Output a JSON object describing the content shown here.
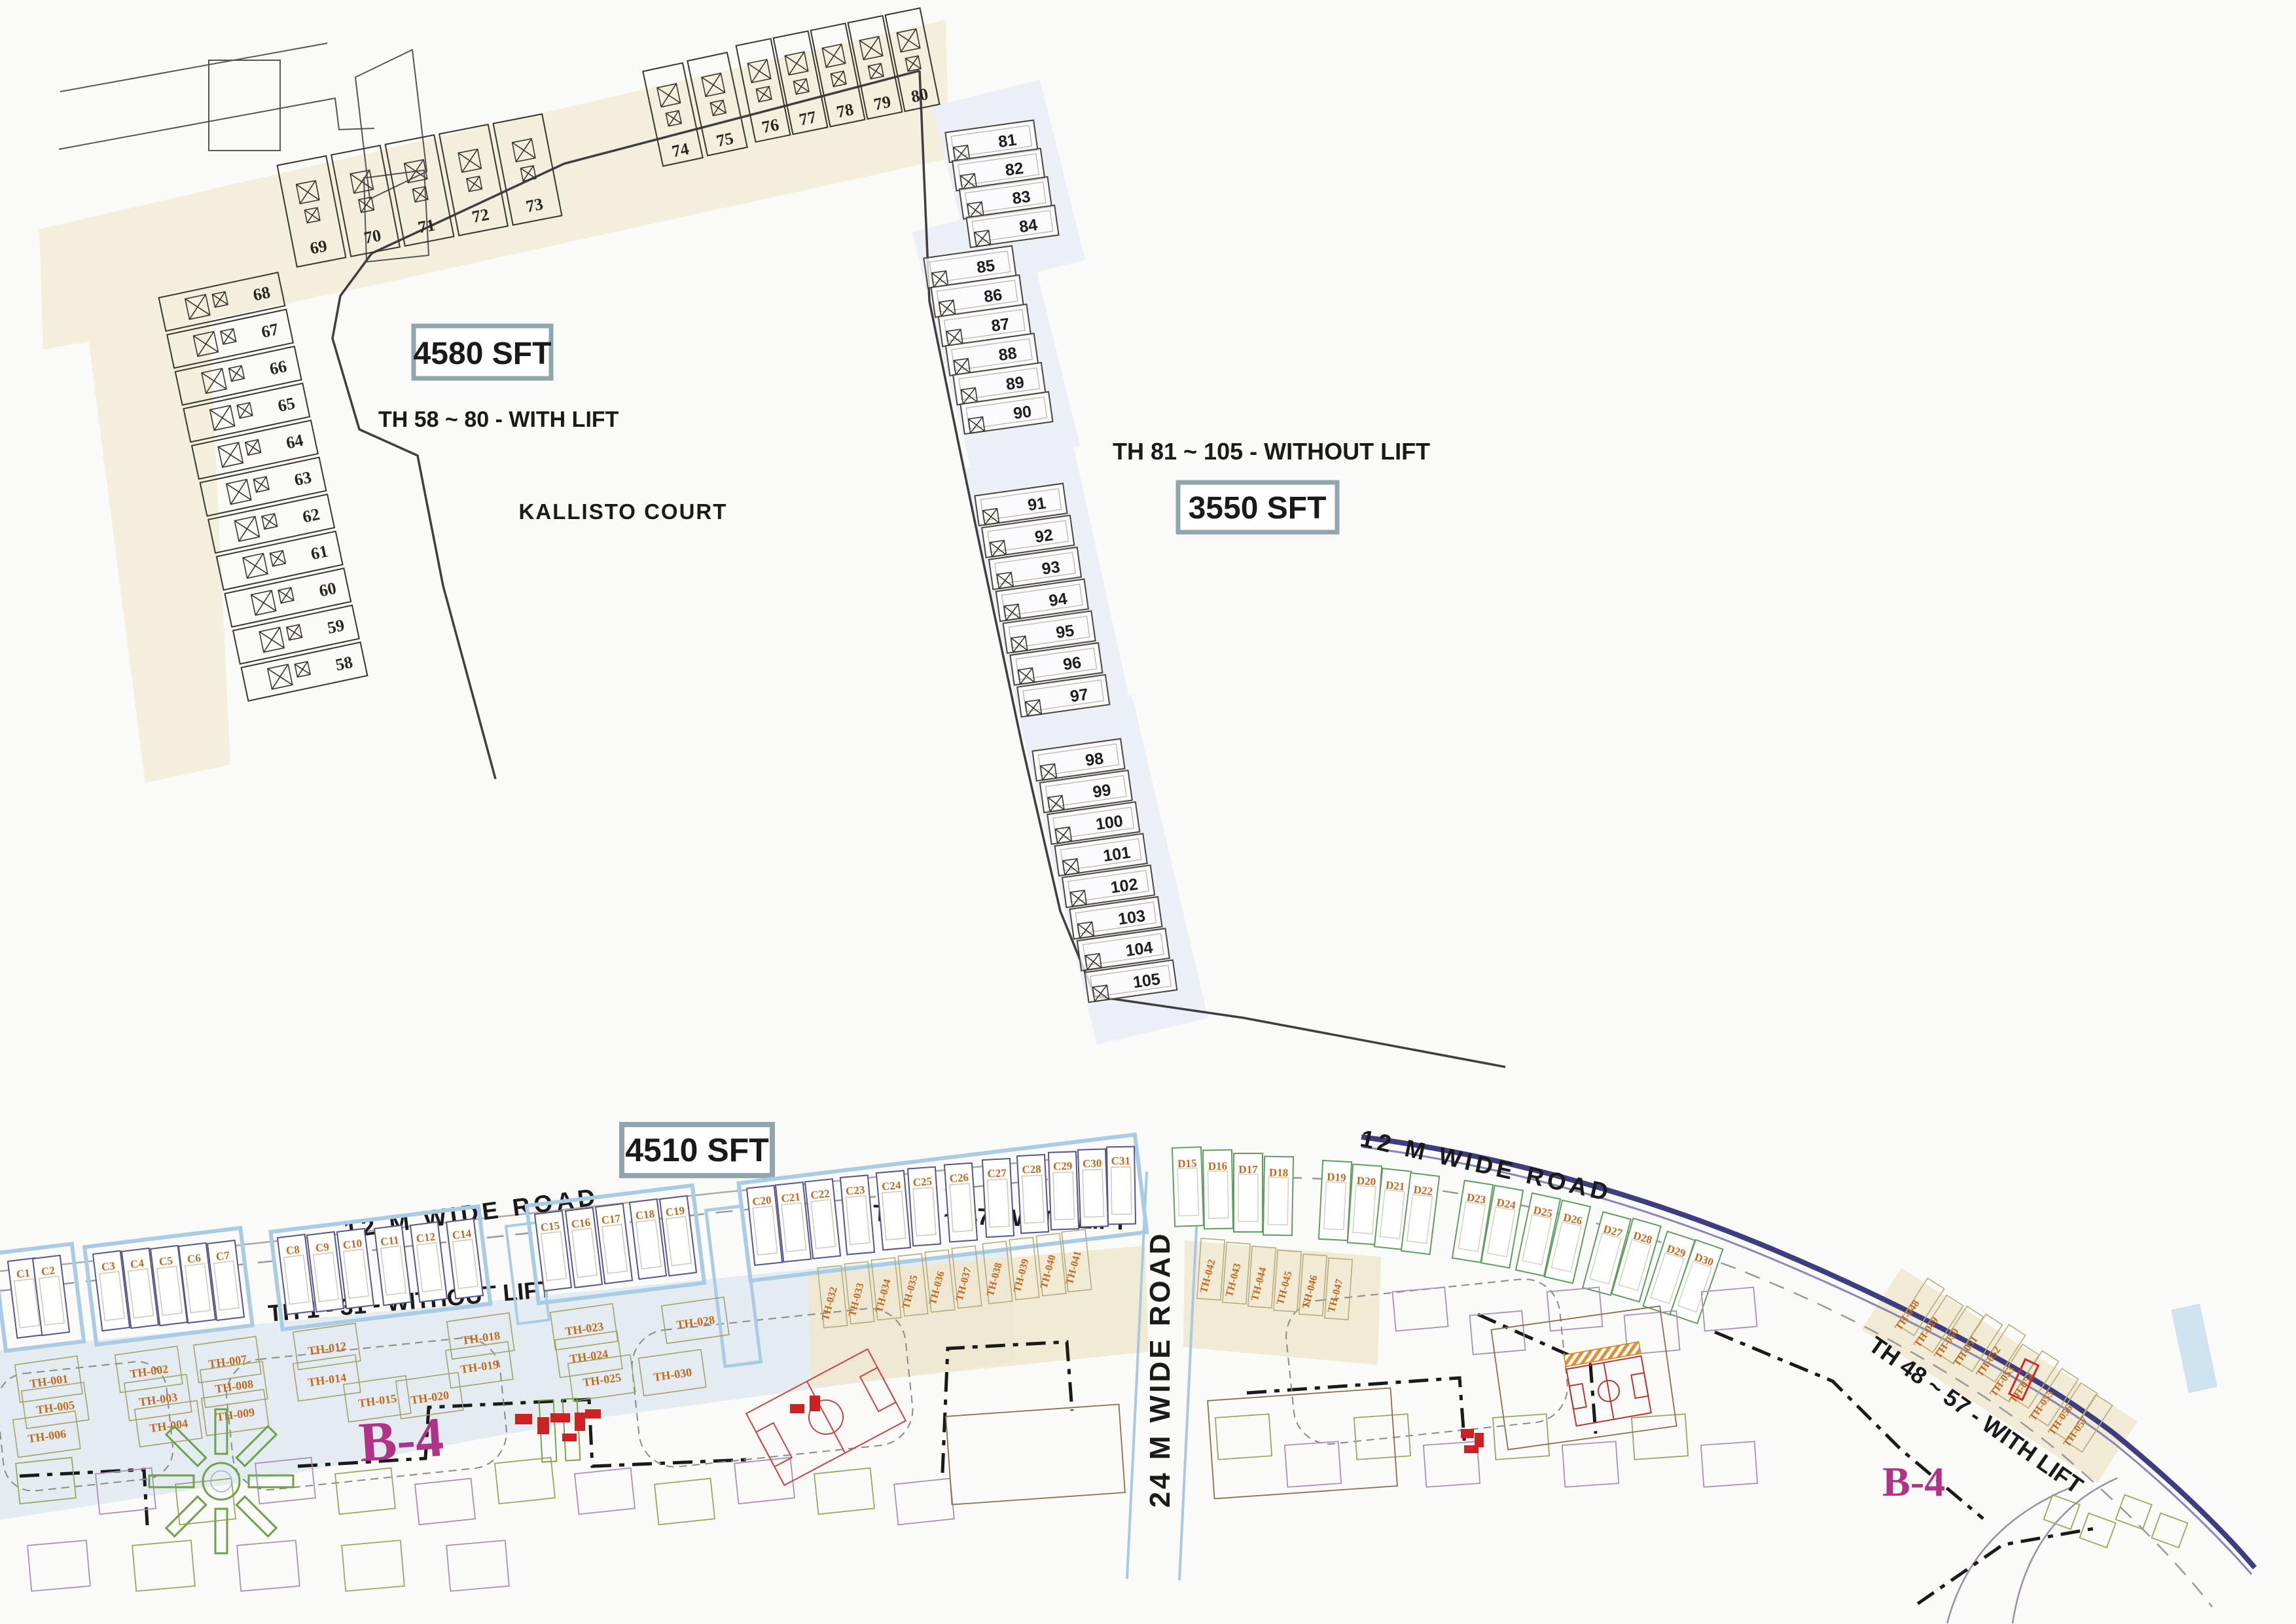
{
  "plan": {
    "court_name": "KALLISTO COURT",
    "areas": {
      "a4580": "4580 SFT",
      "a3550": "3550 SFT",
      "a4510": "4510 SFT"
    },
    "ranges": {
      "r58": "TH 58 ~ 80 - WITH LIFT",
      "r81": "TH 81 ~ 105 - WITHOUT LIFT",
      "r32": "TH 32 ~ 47 - WITH LIFT",
      "r1": "TH 1 - 31 - WITHOUT LIFT",
      "r48": "TH 48 ~ 57 - WITH LIFT"
    },
    "roads": {
      "left12": "12 M WIDE  ROAD",
      "right12": "12 M WIDE  ROAD",
      "v24": "24 M  WIDE  ROAD"
    },
    "blocks": {
      "b4_left": "B-4",
      "b4_right": "B-4"
    },
    "units": {
      "col_68_58": [
        "68",
        "67",
        "66",
        "65",
        "64",
        "63",
        "62",
        "61",
        "60",
        "59",
        "58"
      ],
      "row_69_73": [
        "69",
        "70",
        "71",
        "72",
        "73"
      ],
      "row_74_75": [
        "74",
        "75"
      ],
      "row_76_80": [
        "76",
        "77",
        "78",
        "79",
        "80"
      ],
      "col_81_84": [
        "81",
        "82",
        "83",
        "84"
      ],
      "col_85_90": [
        "85",
        "86",
        "87",
        "88",
        "89",
        "90"
      ],
      "col_91_97": [
        "91",
        "92",
        "93",
        "94",
        "95",
        "96",
        "97"
      ],
      "col_98_105": [
        "98",
        "99",
        "100",
        "101",
        "102",
        "103",
        "104",
        "105"
      ]
    },
    "plots": {
      "c": [
        "C1",
        "C2",
        "C3",
        "C4",
        "C5",
        "C6",
        "C7",
        "C8",
        "C9",
        "C10",
        "C11",
        "C12",
        "C14",
        "C15",
        "C16",
        "C17",
        "C18",
        "C19",
        "C20",
        "C21",
        "C22",
        "C23",
        "C24",
        "C25",
        "C26",
        "C27",
        "C28",
        "C29",
        "C30",
        "C31"
      ],
      "d": [
        "D15",
        "D16",
        "D17",
        "D18",
        "D19",
        "D20",
        "D21",
        "D22",
        "D23",
        "D24",
        "D25",
        "D26",
        "D27",
        "D28",
        "D29",
        "D30"
      ]
    },
    "townhouses": {
      "without_lift": [
        "TH-001",
        "TH-002",
        "TH-003",
        "TH-004",
        "TH-005",
        "TH-006",
        "TH-007",
        "TH-008",
        "TH-009",
        "TH-012",
        "TH-014",
        "TH-015",
        "TH-018",
        "TH-019",
        "TH-020",
        "TH-023",
        "TH-024",
        "TH-025",
        "TH-028",
        "TH-030"
      ],
      "with_lift_32_41": [
        "TH-032",
        "TH-033",
        "TH-034",
        "TH-035",
        "TH-036",
        "TH-037",
        "TH-038",
        "TH-039",
        "TH-040",
        "TH-041"
      ],
      "with_lift_42_47": [
        "TH-042",
        "TH-043",
        "TH-044",
        "TH-045",
        "TH-046",
        "TH-047"
      ],
      "with_lift_48_57": [
        "TH-048",
        "TH-049",
        "TH-050",
        "TH-051",
        "TH-052",
        "TH-053",
        "TH-054",
        "TH-055",
        "TH-056",
        "TH-057"
      ],
      "highlighted": "TH-054"
    },
    "colors": {
      "accent_border": "#8fa6ad",
      "cream": "#f4eedd",
      "lavender": "#edeff6",
      "light_blue_band": "#dde9f0",
      "beige_band": "#efe8cf",
      "orange_label": "#c2691e",
      "olive": "#a8a06a",
      "plot_navy": "#56568c",
      "plot_green": "#5f9e5f",
      "magenta": "#b03387",
      "navy_road": "#3d3d80",
      "red": "#cc2a2a",
      "boundary": "#3f3f3f",
      "text_black": "#1a1a1a",
      "blue_halo": "#aacbe4"
    }
  }
}
